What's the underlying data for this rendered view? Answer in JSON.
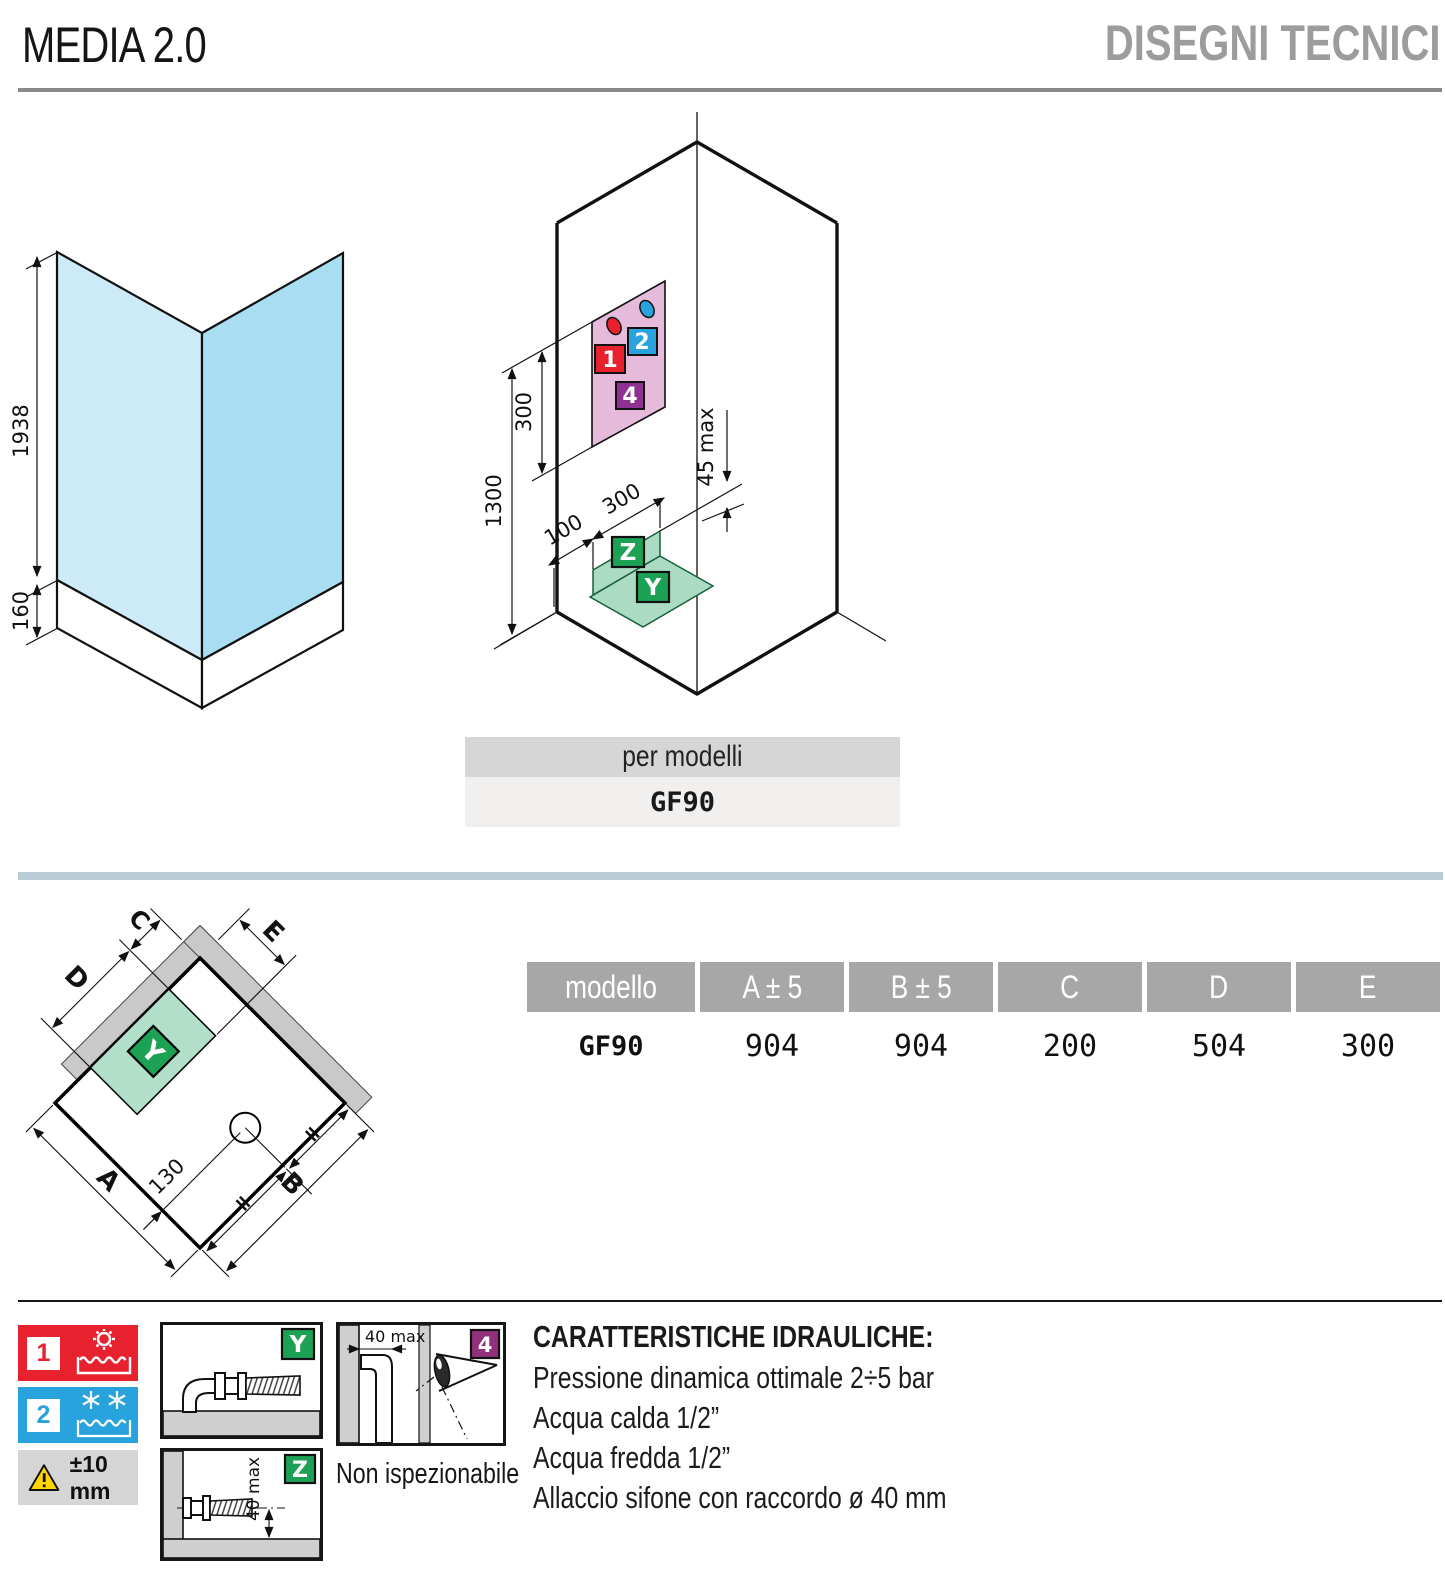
{
  "header": {
    "title": "MEDIA 2.0",
    "subtitle": "DISEGNI TECNICI"
  },
  "left_drawing": {
    "height_label": "1938",
    "base_label": "160"
  },
  "iso_drawing": {
    "dim_300": "300",
    "dim_1300": "1300",
    "dim_100": "100",
    "dim_300_floor": "300",
    "dim_45_max": "45 max",
    "marker_1": "1",
    "marker_2": "2",
    "marker_4": "4",
    "marker_y": "Y",
    "marker_z": "Z"
  },
  "per_modelli": {
    "label": "per modelli",
    "value": "GF90"
  },
  "plan": {
    "dim_a": "A",
    "dim_b": "B",
    "dim_c": "C",
    "dim_d": "D",
    "dim_e": "E",
    "dim_130": "130",
    "equal": "=",
    "marker_y": "Y"
  },
  "table": {
    "headers": [
      "modello",
      "A ± 5",
      "B ± 5",
      "C",
      "D",
      "E"
    ],
    "row": [
      "GF90",
      "904",
      "904",
      "200",
      "504",
      "300"
    ]
  },
  "legend": {
    "hot_number": "1",
    "cold_number": "2",
    "tolerance": "±10 mm",
    "marker_y": "Y",
    "marker_z": "Z",
    "marker_4": "4",
    "dim_40_wall": "40 max",
    "dim_40_floor": "40 max",
    "non_inspectable": "Non ispezionabile"
  },
  "hydraulic": {
    "title": "CARATTERISTICHE IDRAULICHE:",
    "lines": [
      "Pressione dinamica ottimale 2÷5 bar",
      "Acqua calda 1/2”",
      "Acqua fredda 1/2”",
      "Allaccio sifone con raccordo ø 40 mm"
    ]
  },
  "colors": {
    "hot_red": "#e8212e",
    "cold_blue": "#29a3dd",
    "purple_4": "#8e3192",
    "magenta_4": "#93307c",
    "green_marker": "#1da155",
    "pink_zone": "#e6bada",
    "green_zone": "#abdcc3",
    "glass_light": "#cdeaf8",
    "glass_dark": "#a9def2",
    "table_header_gray": "#a7a7a7",
    "divider_blue": "#b9ccd6",
    "warning_yellow": "#ffd400"
  }
}
